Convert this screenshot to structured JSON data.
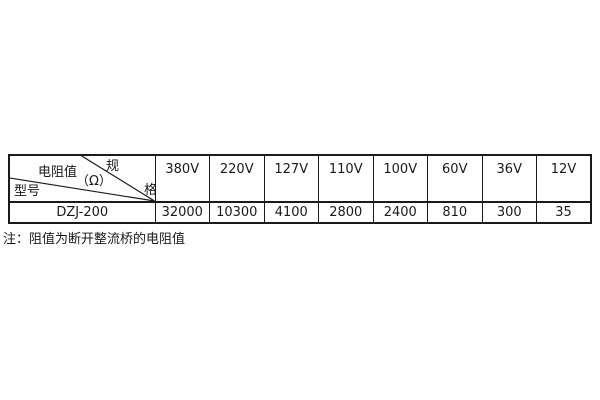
{
  "table": {
    "corner": {
      "spec_char_top": "规",
      "spec_char_bottom": "格",
      "resistance_label": "电阻值",
      "ohm_label": "（Ω）",
      "model_label": "型号"
    },
    "columns": [
      "380V",
      "220V",
      "127V",
      "110V",
      "100V",
      "60V",
      "36V",
      "12V"
    ],
    "rows": [
      {
        "model": "DZJ-200",
        "values": [
          "32000",
          "10300",
          "4100",
          "2800",
          "2400",
          "810",
          "300",
          "35"
        ]
      }
    ]
  },
  "note": "注：阻值为断开整流桥的电阻值",
  "colors": {
    "border": "#1a1a1a",
    "text": "#1a1a1a",
    "background": "#ffffff"
  }
}
